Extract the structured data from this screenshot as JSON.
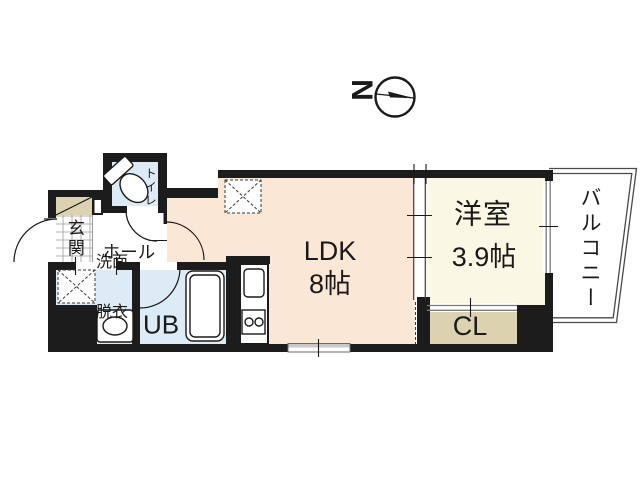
{
  "compass": {
    "letter": "N"
  },
  "rooms": {
    "toilet": {
      "label": "トイレ"
    },
    "entrance": {
      "label": "玄関"
    },
    "hall": {
      "label": "ホール"
    },
    "washroom": {
      "line1": "洗面",
      "line2": "脱衣"
    },
    "unit_bath": {
      "label": "UB"
    },
    "ldk": {
      "label": "LDK",
      "size": "8帖"
    },
    "western_room": {
      "label": "洋室",
      "size": "3.9帖"
    },
    "closet": {
      "label": "CL"
    },
    "balcony": {
      "label": "バルコニー"
    }
  },
  "colors": {
    "wall": "#1c1c1c",
    "ldk_floor": "#fbe7d6",
    "western_floor": "#faf7e4",
    "wet_area_floor": "#dcebf6",
    "closet_floor": "#dcd2b0",
    "window_line": "#7a7a7a",
    "balcony_outline": "#4a4a4a"
  }
}
